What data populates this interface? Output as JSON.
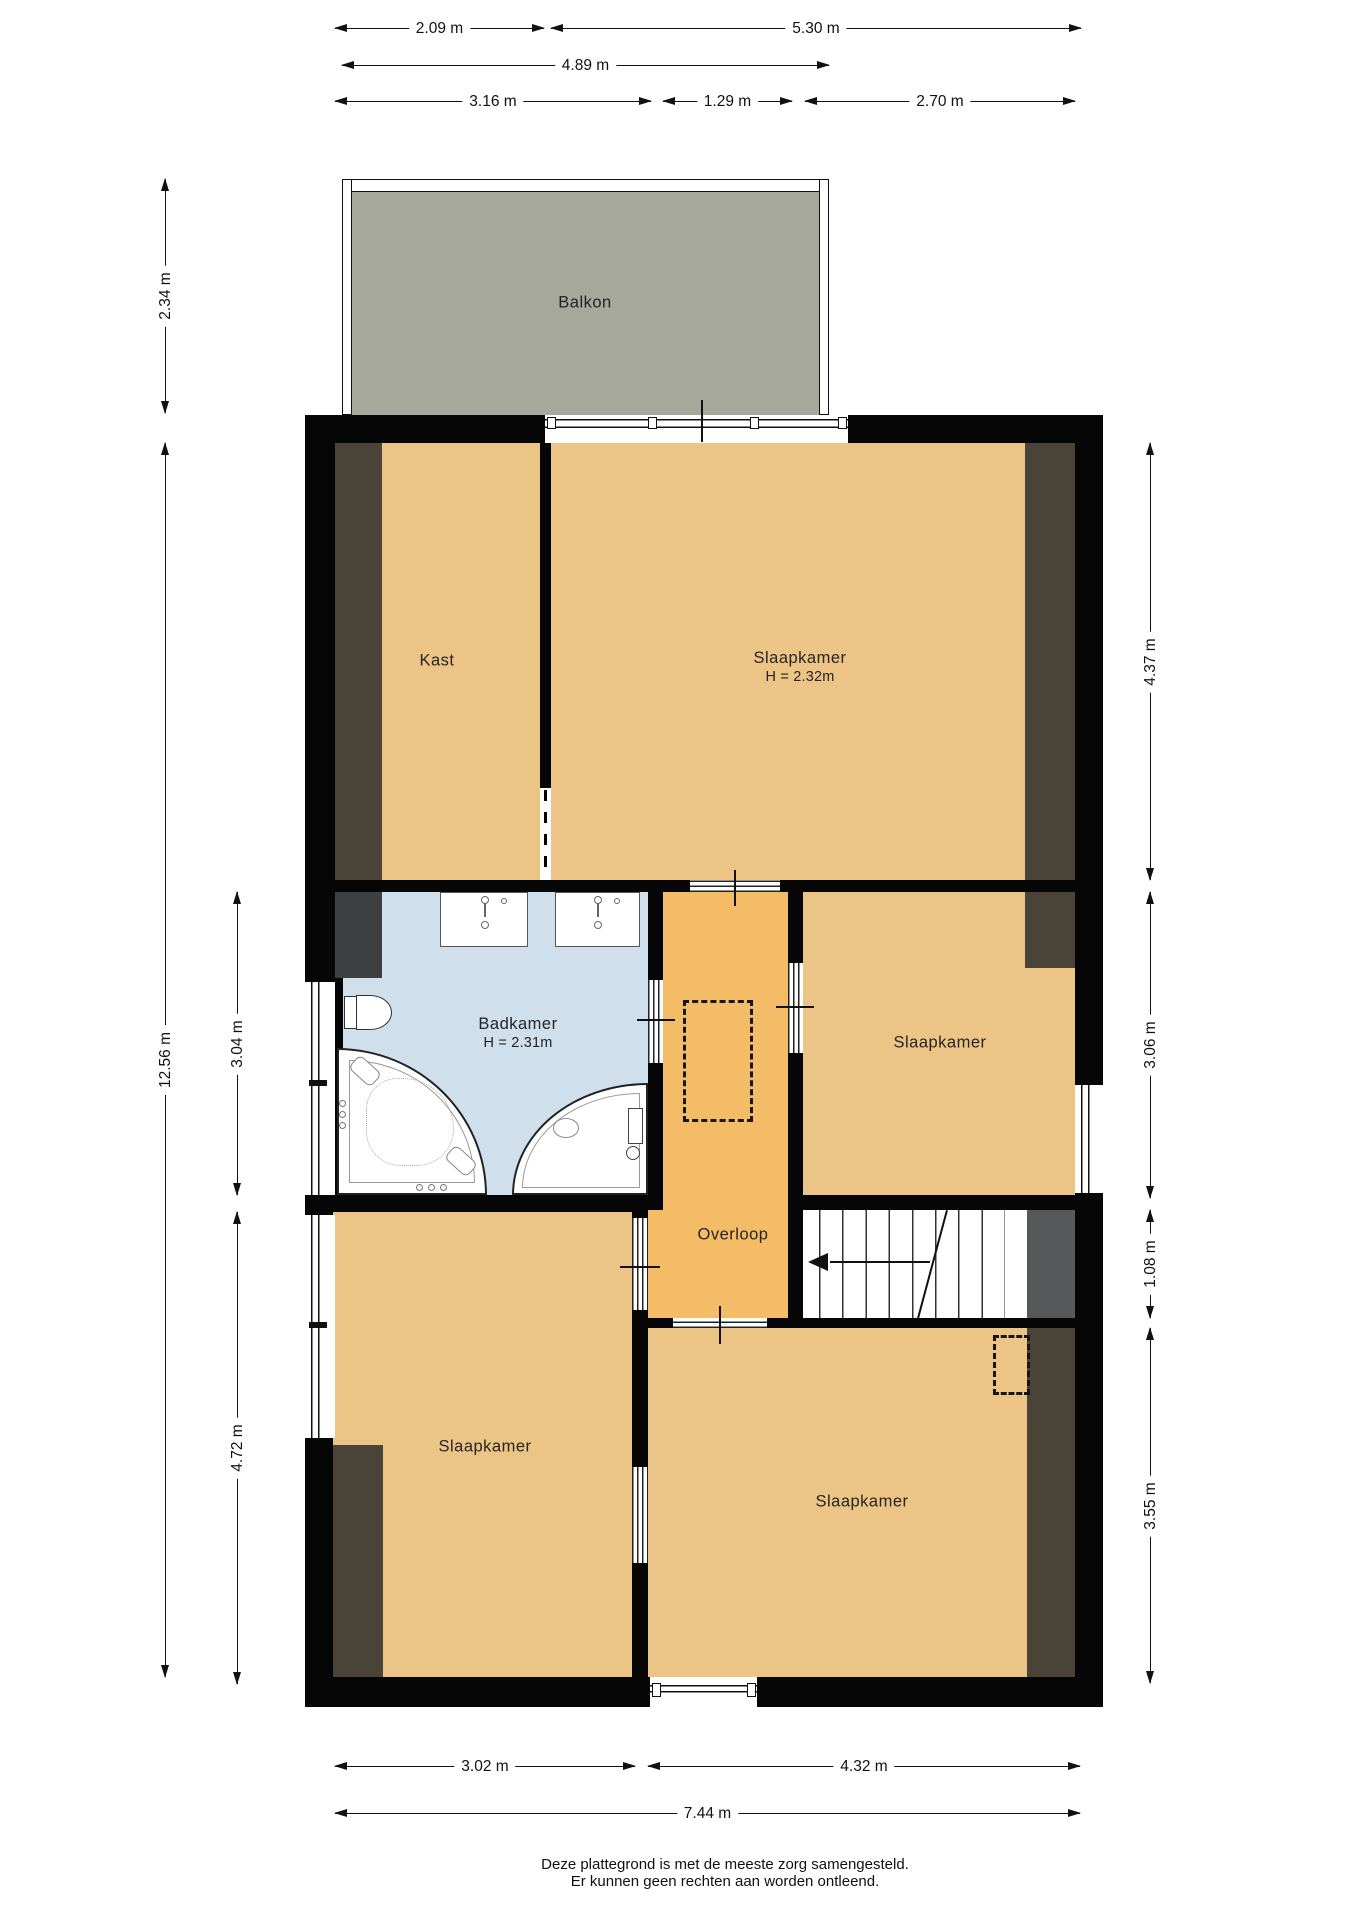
{
  "title": "Plattegrond eerste verdieping",
  "rooms": {
    "balkon": {
      "label": "Balkon"
    },
    "kast": {
      "label": "Kast"
    },
    "slaapkamer_boven": {
      "label": "Slaapkamer",
      "height": "H = 2.32m"
    },
    "badkamer": {
      "label": "Badkamer",
      "height": "H = 2.31m"
    },
    "slaapkamer_midden": {
      "label": "Slaapkamer"
    },
    "overloop": {
      "label": "Overloop"
    },
    "slaapkamer_linksonder": {
      "label": "Slaapkamer"
    },
    "slaapkamer_rechtsonder": {
      "label": "Slaapkamer"
    }
  },
  "dimensions": {
    "t_209": "2.09 m",
    "t_530": "5.30 m",
    "t_489": "4.89 m",
    "t_316": "3.16 m",
    "t_129": "1.29 m",
    "t_270": "2.70 m",
    "l_234": "2.34 m",
    "l_1256": "12.56 m",
    "l_304": "3.04 m",
    "l_472": "4.72 m",
    "r_437": "4.37 m",
    "r_306": "3.06 m",
    "r_108": "1.08 m",
    "r_355": "3.55 m",
    "b_302": "3.02 m",
    "b_432": "4.32 m",
    "b_744": "7.44 m"
  },
  "footer": {
    "line1": "Deze plattegrond is met de meeste zorg samengesteld.",
    "line2": "Er kunnen geen rechten aan worden ontleend."
  },
  "colors": {
    "wall": "#060606",
    "floor": "#ecc485",
    "hall_floor": "#f4bc66",
    "bath_floor": "#cfdfeb",
    "balcony_floor": "#a5a89a",
    "sloped_attic": "#4a4337",
    "void_grey": "#57585a"
  }
}
